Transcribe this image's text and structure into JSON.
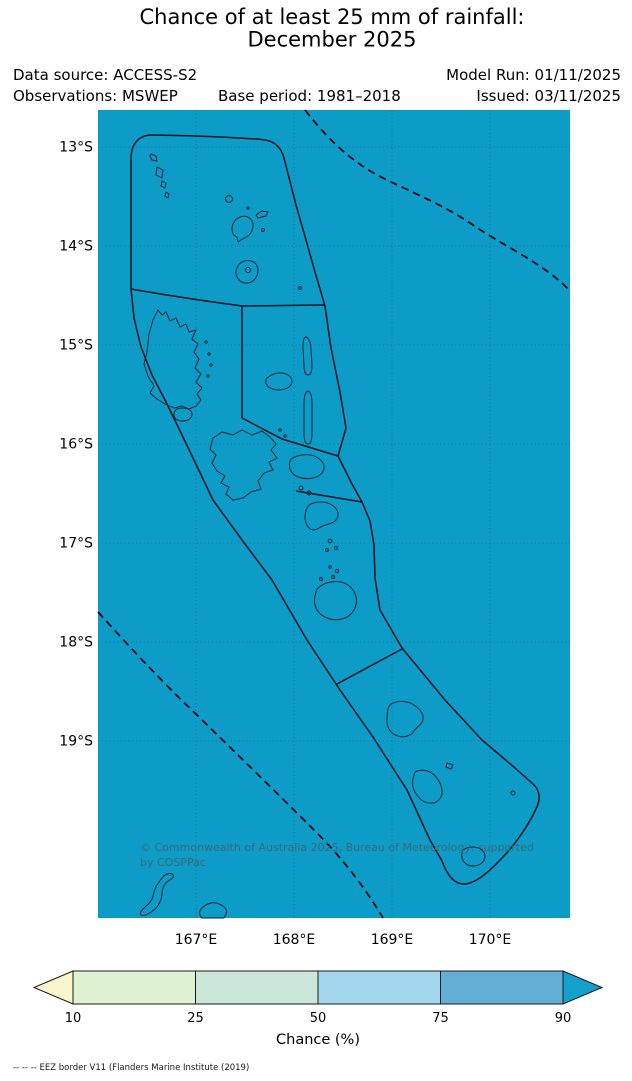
{
  "title": {
    "line1": "Chance of at least 25 mm of rainfall:",
    "line2": "December 2025"
  },
  "metadata": {
    "data_source": "Data source: ACCESS-S2",
    "model_run": "Model Run: 01/11/2025",
    "observations": "Observations: MSWEP",
    "base_period": "Base period: 1981–2018",
    "issued": "Issued: 03/11/2025"
  },
  "map": {
    "lat_labels": [
      "13°S",
      "14°S",
      "15°S",
      "16°S",
      "17°S",
      "18°S",
      "19°S"
    ],
    "lon_labels": [
      "167°E",
      "168°E",
      "169°E",
      "170°E"
    ],
    "copyright_line1": "© Commonwealth of Australia 2025, Bureau of Meteorology, supported",
    "copyright_line2": "by COSPPac",
    "sea_fill_color": "#0d9cc8",
    "region_border_color": "#01131c",
    "eez_border_style": "dashed black"
  },
  "colorbar": {
    "label": "Chance (%)",
    "ticks": [
      "10",
      "25",
      "50",
      "75",
      "90"
    ],
    "segment_colors": {
      "below_10": "#f9f5cc",
      "10_25": "#def2d1",
      "25_50": "#cbe7d9",
      "50_75": "#a3d7ee",
      "75_90": "#62aed5",
      "above_90": "#14a0cd"
    }
  },
  "footer": {
    "eez_note": "-- -- -- EEZ border V11 (Flanders Marine Institute (2019)"
  },
  "chart_data": {
    "type": "heatmap",
    "title": "Chance of at least 25 mm of rainfall: December 2025",
    "legend_label": "Chance (%)",
    "legend_ticks": [
      10,
      25,
      50,
      75,
      90
    ],
    "map_extent": {
      "lon_range": [
        "166°E",
        "170.8°E"
      ],
      "lat_range": [
        "12.6°S",
        "20.8°S"
      ]
    },
    "depicted_values": "All Vanuatu EEZ forecast regions are shaded in the >90% chance colour"
  }
}
